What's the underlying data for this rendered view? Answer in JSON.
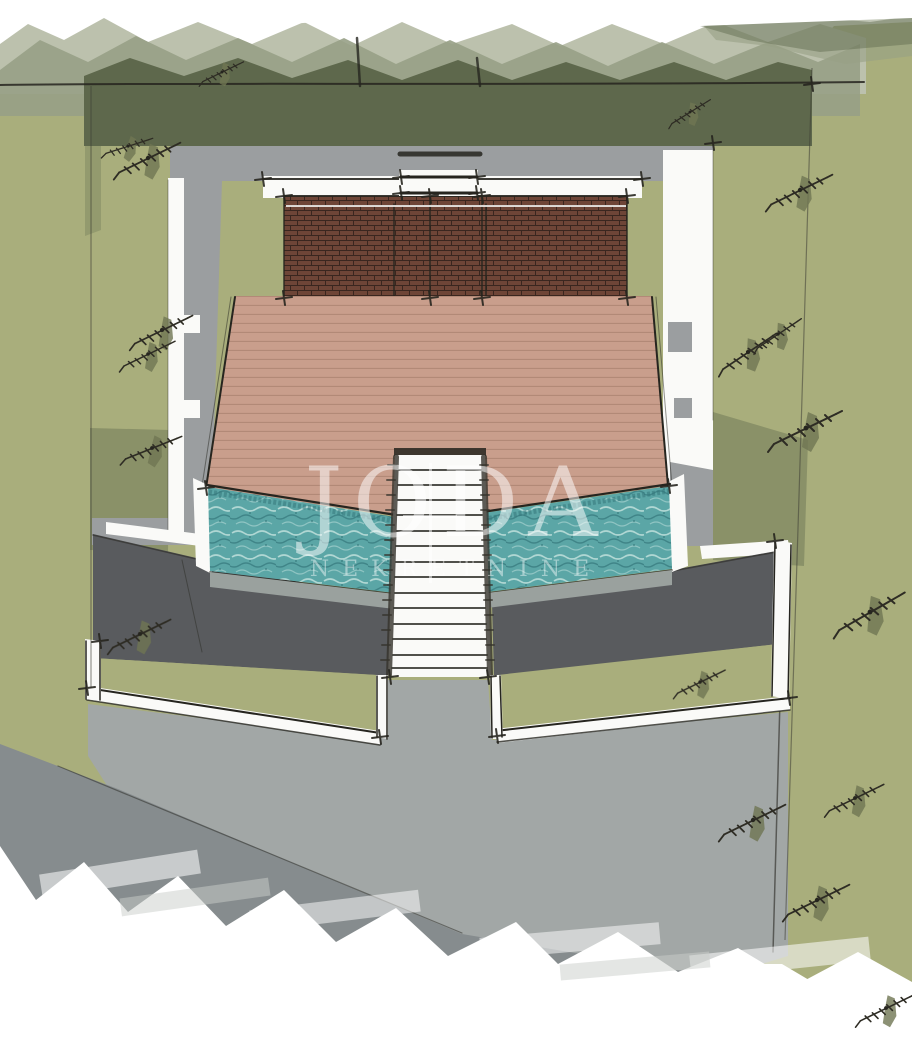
{
  "watermark": {
    "line1": "JODA",
    "line2": "NEKRETNINE"
  },
  "scene_description": "Hand-drawn architectural site plan, top view: house with brick pergola roof, wooden deck terrace, two pools flanking a central staircase, surrounded by lawns, concrete surfaces and an access road",
  "palette": {
    "paper": "#ffffff",
    "lawn": "#a9ae7c",
    "lawn_dark": "#8a9168",
    "hedge_light": "#bcc1ad",
    "hedge_mid": "#97a086",
    "hedge_dark": "#5e684c",
    "concrete": "#9b9ea0",
    "slope_dark": "#595b5e",
    "drive": "#a2a7a6",
    "drive_dark": "#868c8e",
    "wall_white": "#fafaf8",
    "ink": "#26251f",
    "deck": "#c99e8c",
    "deck_line": "#b28977",
    "brick": "#6e4537",
    "brick_line": "#31211b",
    "pool": "#5ba6a6",
    "pool_dark": "#35787c",
    "pool_light": "#c6e3df",
    "pool_band": "#9aa19e",
    "watermark": "rgba(255,255,255,0.52)"
  }
}
